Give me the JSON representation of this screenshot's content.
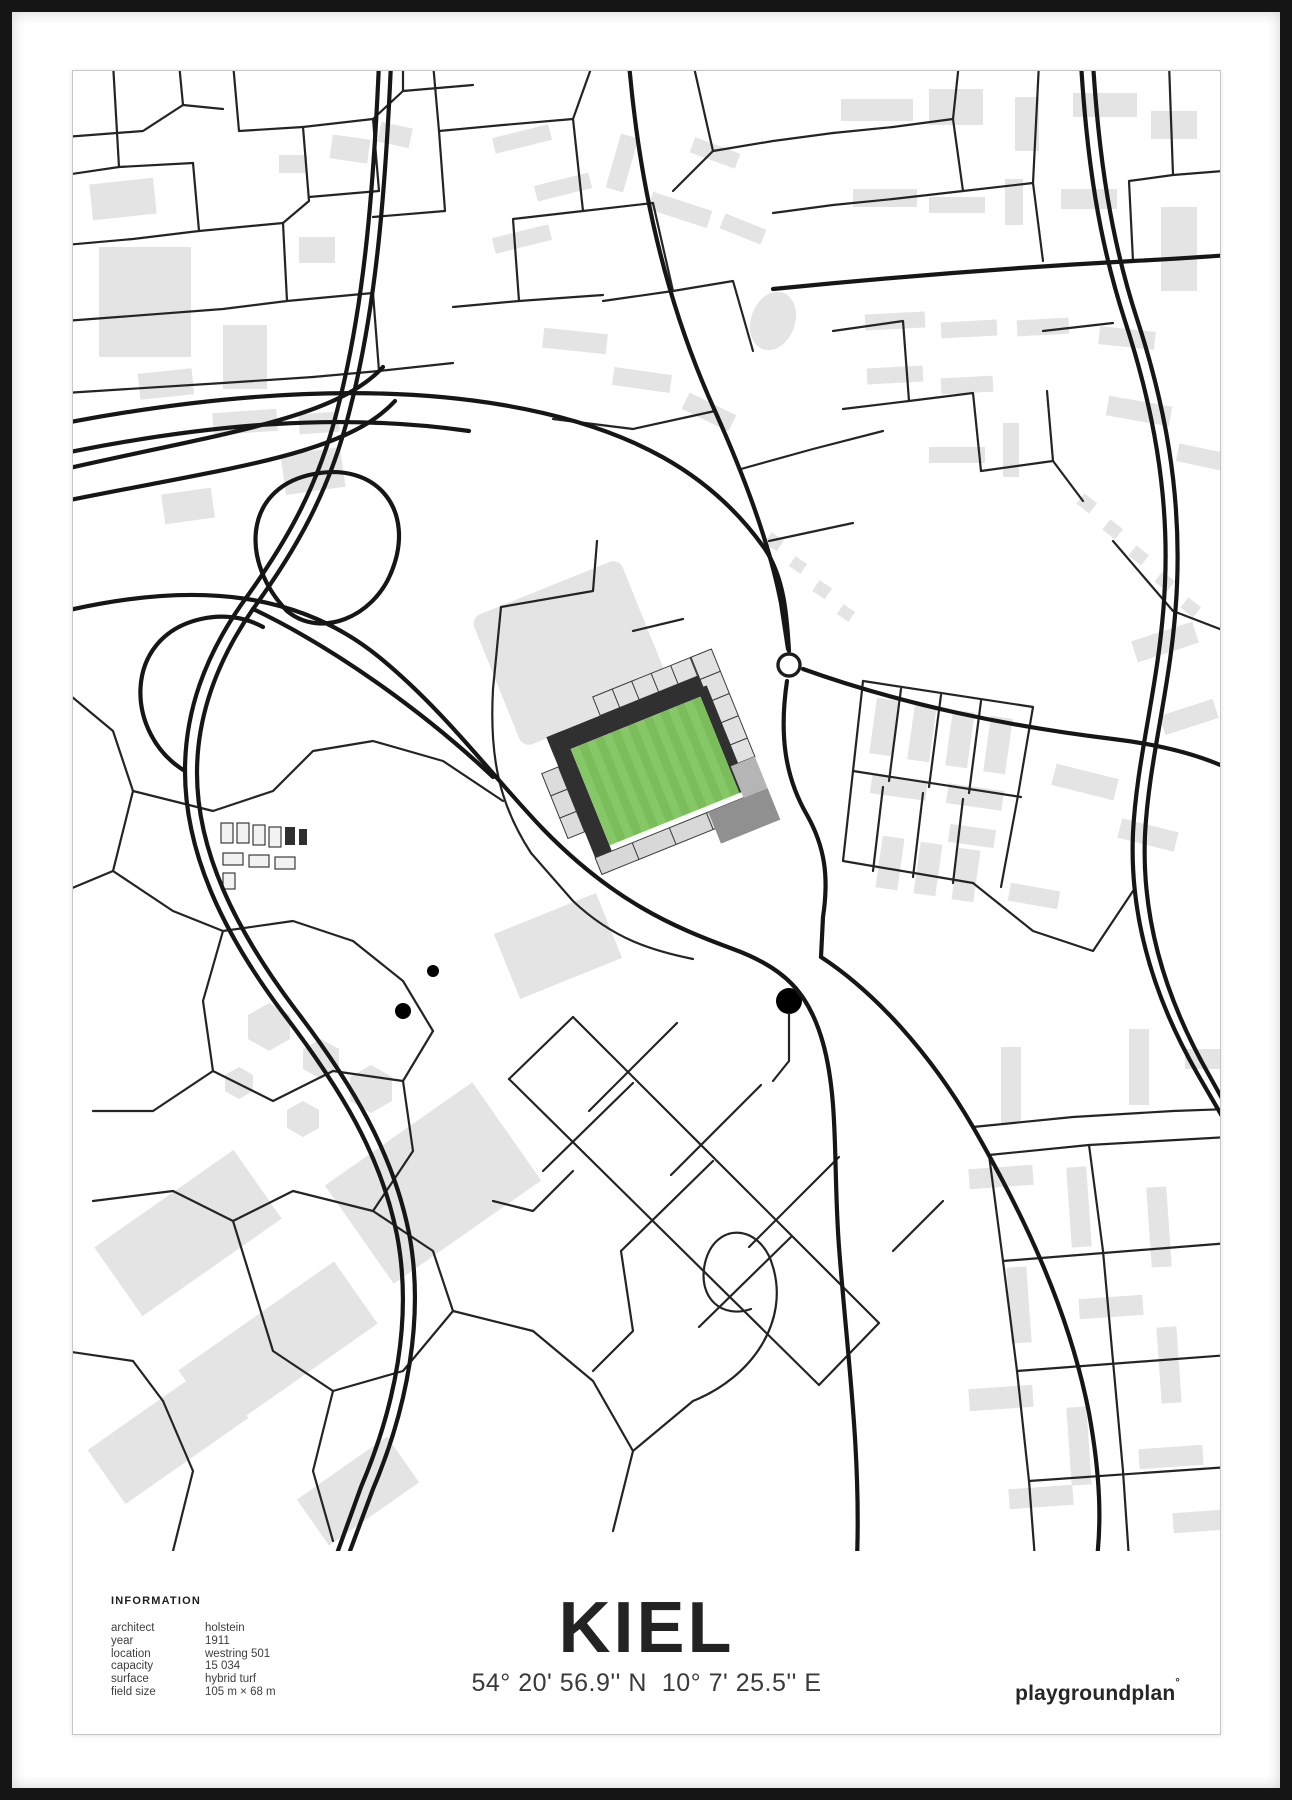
{
  "poster": {
    "title": "KIEL",
    "coordinates": "54° 20' 56.9'' N  10° 7' 25.5'' E",
    "brand": "playgroundplan",
    "brand_mark": "°",
    "info": {
      "heading": "INFORMATION",
      "rows": [
        {
          "label": "architect",
          "value": "holstein"
        },
        {
          "label": "year",
          "value": "1911"
        },
        {
          "label": "location",
          "value": "westring 501"
        },
        {
          "label": "capacity",
          "value": "15 034"
        },
        {
          "label": "surface",
          "value": "hybrid turf"
        },
        {
          "label": "field size",
          "value": "105 m × 68 m"
        }
      ]
    },
    "map": {
      "landmark": "holstein-stadion",
      "features": [
        "street-network",
        "buildings",
        "motorway-interchange",
        "roundabout",
        "stadium-pitch"
      ],
      "colors": {
        "pitch_green": "#7abd5a",
        "pitch_stripe": "#86c768",
        "street": "#1d1d1d",
        "building": "#e4e4e4",
        "stand_dark": "#303030",
        "stand_light": "#e2e2e2",
        "frame": "#151515"
      }
    }
  }
}
